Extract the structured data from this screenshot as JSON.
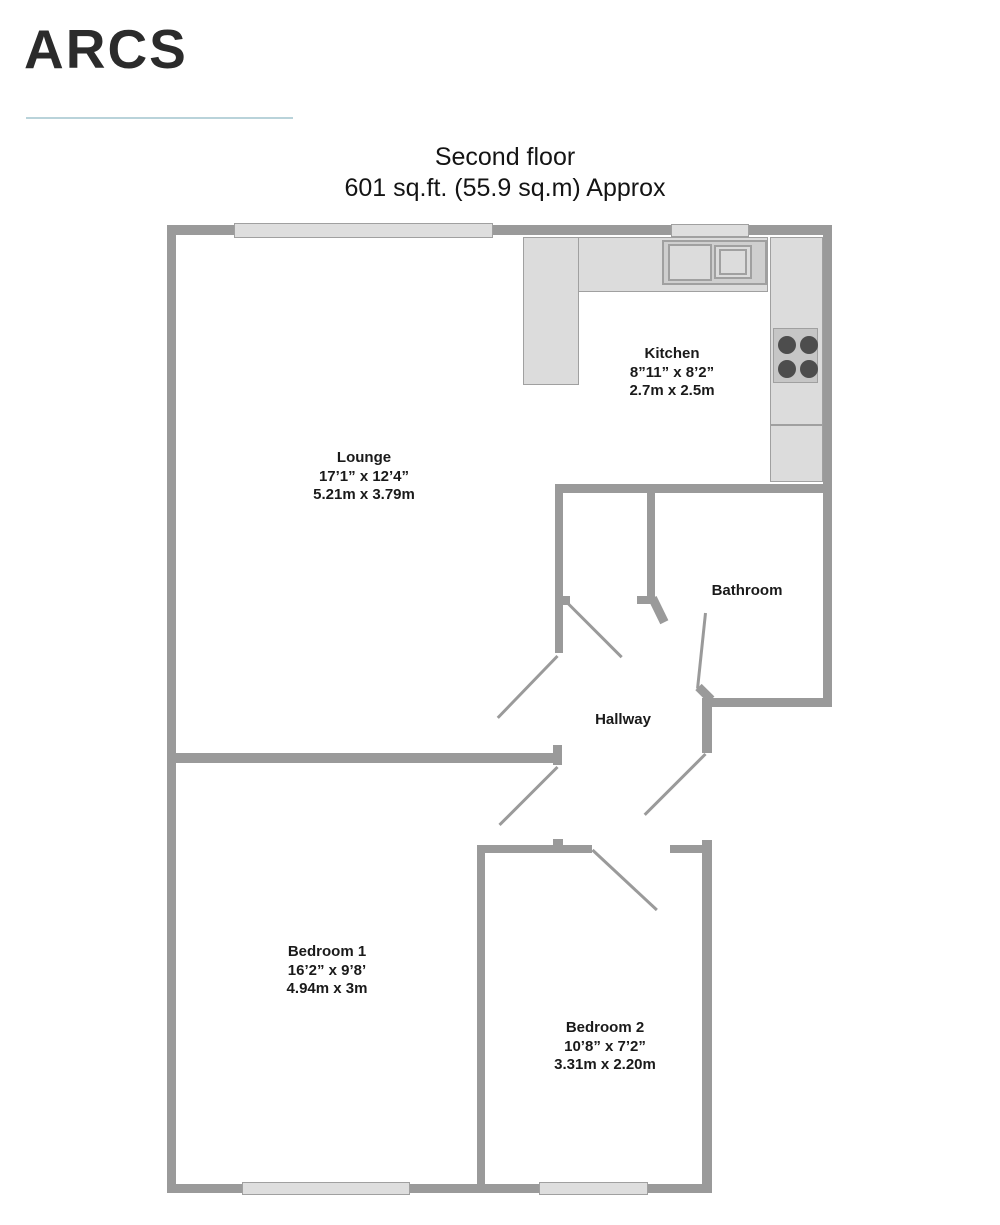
{
  "brand": {
    "logo": "ARCS"
  },
  "title": {
    "line1": "Second floor",
    "line2": "601 sq.ft. (55.9 sq.m) Approx"
  },
  "rooms": {
    "lounge": {
      "name": "Lounge",
      "imperial": "17’1” x 12’4”",
      "metric": "5.21m x 3.79m"
    },
    "kitchen": {
      "name": "Kitchen",
      "imperial": "8”11” x 8’2”",
      "metric": "2.7m x 2.5m"
    },
    "bathroom": {
      "name": "Bathroom"
    },
    "hallway": {
      "name": "Hallway"
    },
    "bedroom1": {
      "name": "Bedroom 1",
      "imperial": "16’2” x 9’8’",
      "metric": "4.94m x 3m"
    },
    "bedroom2": {
      "name": "Bedroom 2",
      "imperial": "10’8” x 7’2”",
      "metric": "3.31m x 2.20m"
    }
  },
  "colors": {
    "wall": "#9a9a9a",
    "fixture_fill": "#dcdcdc",
    "fixture_border": "#a0a0a0",
    "sink_fill": "#cfcfcf",
    "window_fill": "#dedede",
    "burner": "#4d4d4d",
    "divider_accent": "#b9d3da",
    "text": "#1a1a1a",
    "logo_text": "#2b2b2b"
  }
}
